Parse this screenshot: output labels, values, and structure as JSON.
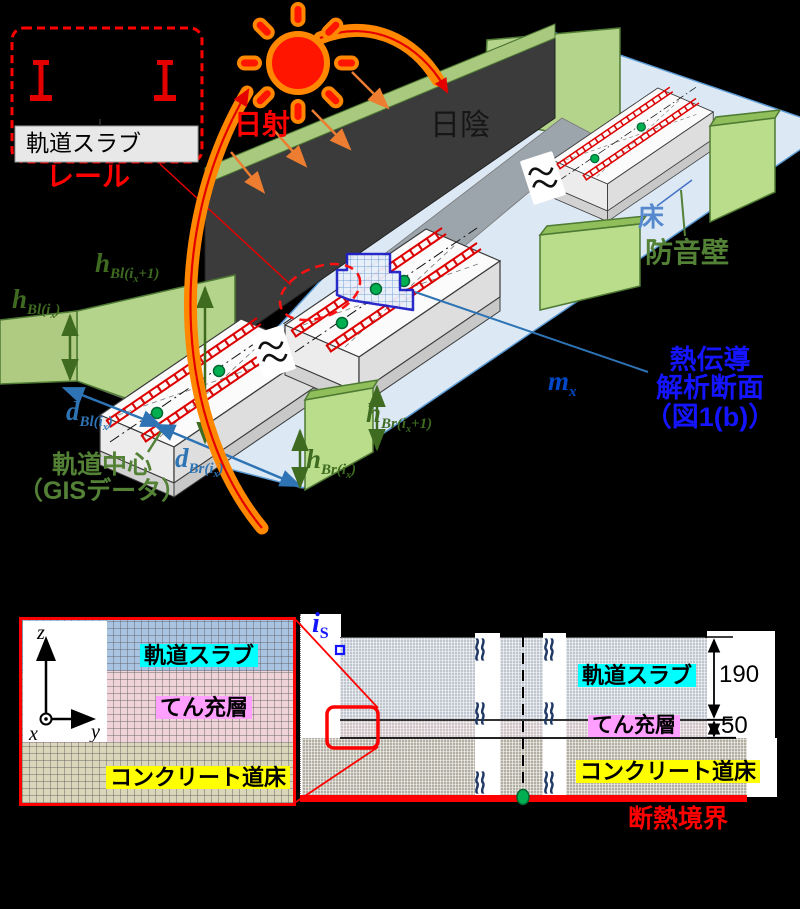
{
  "colors": {
    "accent_red": "#E50000",
    "accent_orange": "#FF8800",
    "barrier_green": "#B5D48B",
    "deck_blue": "#DCE9F5",
    "label_green": "#3F6B21",
    "label_blue": "#2E74B5",
    "vivid_blue": "#1414FF",
    "highlight_cyan": "#00FFFF",
    "highlight_pink": "#FF9FFF",
    "highlight_yellow": "#FFFF00"
  },
  "fig_a": {
    "box_slab_label": "軌道スラブ",
    "rail_label": "レール",
    "sun_label": "日射",
    "shade_label": "日陰",
    "floor_label": "床",
    "barrier_label": "防音壁",
    "center_label_1": "軌道中心",
    "center_label_2": "（GISデータ）",
    "analysis_label_1": "熱伝導",
    "analysis_label_2": "解析断面",
    "analysis_label_3": "（図1(b)）",
    "vars": {
      "h_bl_next": {
        "b": "h",
        "s1": "Bl(i",
        "sx": "x",
        "s2": "+1)"
      },
      "h_bl": {
        "b": "h",
        "s1": "Bl(i",
        "sx": "x",
        "s2": ")"
      },
      "d_bl": {
        "b": "d",
        "s1": "Bl(i",
        "sx": "x",
        "s2": ")"
      },
      "d_br": {
        "b": "d",
        "s1": "Br(i",
        "sx": "x",
        "s2": ")"
      },
      "h_br_next": {
        "b": "h",
        "s1": "Br(i",
        "sx": "x",
        "s2": "+1)"
      },
      "h_br": {
        "b": "h",
        "s1": "Br(i",
        "sx": "x",
        "s2": ")"
      },
      "m_x": {
        "b": "m",
        "sx": "x"
      }
    }
  },
  "fig_b": {
    "axes": {
      "z": "z",
      "y": "y",
      "x": "x"
    },
    "inset": {
      "slab": "軌道スラブ",
      "filling": "てん充層",
      "ballast": "コンクリート道床"
    },
    "section": {
      "slab": "軌道スラブ",
      "filling": "てん充層",
      "ballast": "コンクリート道床"
    },
    "node": {
      "b": "i",
      "s": "S"
    },
    "dims": {
      "slab": "190",
      "filling": "50"
    },
    "adiabatic_label": "断熱境界",
    "break_glyph": "≈≈"
  }
}
